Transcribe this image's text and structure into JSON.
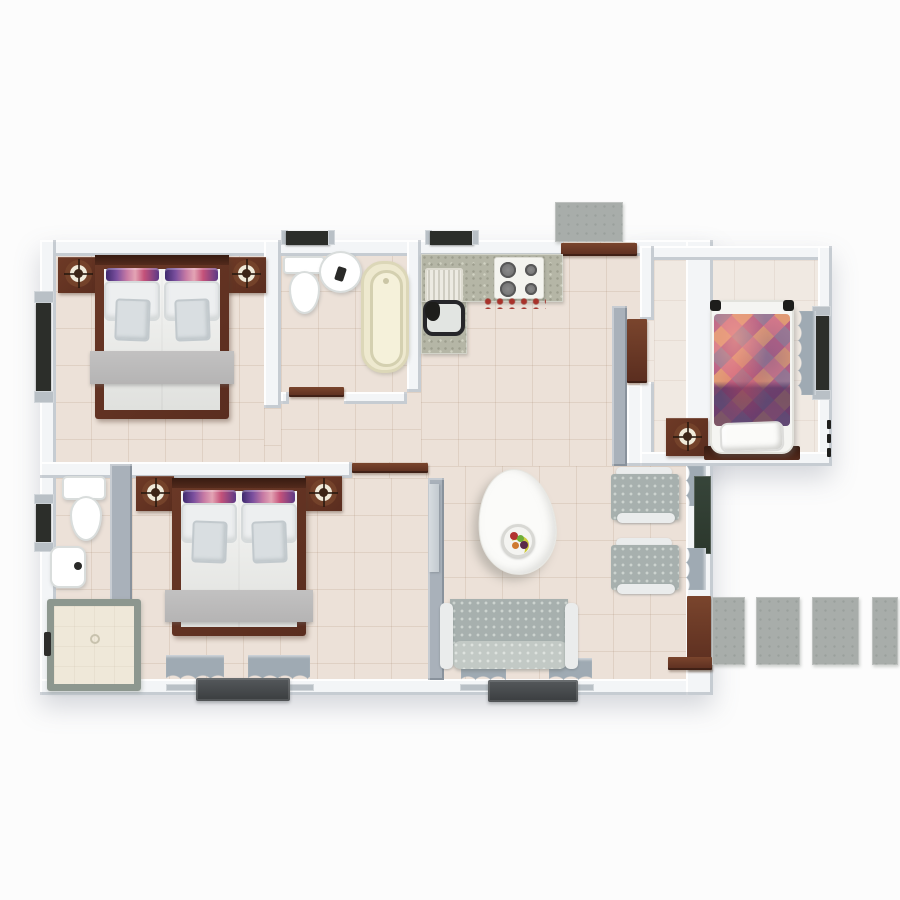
{
  "scene": {
    "type": "3d-floor-plan-top-view",
    "description": "Top-down 3D architectural render of a small house: two double bedrooms, two bathrooms, open kitchen/living-dining area, and a single-bed annex room, with exterior concrete entry pad, garden pavers and two outdoor units",
    "background": "#fcfcfc"
  },
  "palette": {
    "wall": "#f3f5f7",
    "wallGray": "#a9b1ba",
    "floor": "#ece1d8",
    "floorAnnex": "#f0e9e2",
    "tileLine": "rgba(155,122,96,0.16)",
    "wood": "#5a2d1f",
    "woodMid": "#6e3a26",
    "duvet": "#e9eae7",
    "pillow": "#edeff0",
    "cushion": "#d9dee1",
    "throwGray": "#b5b4b4",
    "fabric": "#a7b0ae",
    "fabricDot": "#ccd3cf",
    "armrest": "#eaecec",
    "curtain": "#9faab3",
    "glassDark": "#2b372c",
    "frameDark": "#2c2e2a",
    "concrete": "#a8adaa",
    "concreteDot": "#9aa09c",
    "granite": "#b5b6a6",
    "tub": "#f2eed4",
    "acUnit": "#3a3d3f",
    "accessoryRed": "#a8322a",
    "lampRing": "#74422a",
    "lampFace": "#f0ead9",
    "sill": "#b9c0c6"
  },
  "rooms": [
    {
      "id": "bedroom-1",
      "position": "top-left",
      "furniture": [
        "double-bed",
        "headboard",
        "two-accent-pillows",
        "two-pillows",
        "two-cushions",
        "gray-foot-throw",
        "nightstand-left",
        "table-lamp",
        "nightstand-right",
        "table-lamp",
        "window-left-wall"
      ]
    },
    {
      "id": "bathroom-1",
      "position": "top-center",
      "furniture": [
        "toilet",
        "pedestal-sink",
        "bathtub",
        "window-top-wall",
        "door"
      ]
    },
    {
      "id": "kitchen",
      "position": "top-center-right",
      "furniture": [
        "l-shaped-granite-counter",
        "sink-with-drainer",
        "four-burner-hob",
        "red-accessories",
        "window-top-wall"
      ]
    },
    {
      "id": "entry",
      "position": "top",
      "furniture": [
        "entrance-door-open",
        "concrete-landing"
      ]
    },
    {
      "id": "bedroom-annex",
      "position": "top-right",
      "furniture": [
        "single-bed",
        "diamond-pattern-quilt",
        "pillow",
        "dark-headboard",
        "nightstand",
        "table-lamp",
        "window-right-wall-with-curtains",
        "door-open"
      ]
    },
    {
      "id": "living-dining",
      "position": "center",
      "furniture": [
        "egg-shaped-dining-table",
        "fruit-plate",
        "armchair",
        "armchair",
        "sofa",
        "window-bottom-wall-with-curtains",
        "sliding-glass-window-right-wall",
        "garden-door",
        "outdoor-unit"
      ]
    },
    {
      "id": "bedroom-2",
      "position": "bottom-left",
      "furniture": [
        "double-bed",
        "headboard",
        "two-accent-pillows",
        "two-pillows",
        "two-cushions",
        "gray-foot-throw",
        "nightstand-left",
        "table-lamp",
        "nightstand-right",
        "table-lamp",
        "window-bottom-wall-with-curtains",
        "door-open"
      ]
    },
    {
      "id": "bathroom-2",
      "position": "bottom-far-left",
      "furniture": [
        "toilet-with-tank",
        "wall-hung-sink",
        "shower-cubicle",
        "window-left-wall"
      ]
    }
  ],
  "exterior": {
    "pavers_count": 4,
    "outdoor_units_count": 2,
    "entry_landing": "concrete-pad-top",
    "dimension_ticks": "right-of-annex"
  }
}
